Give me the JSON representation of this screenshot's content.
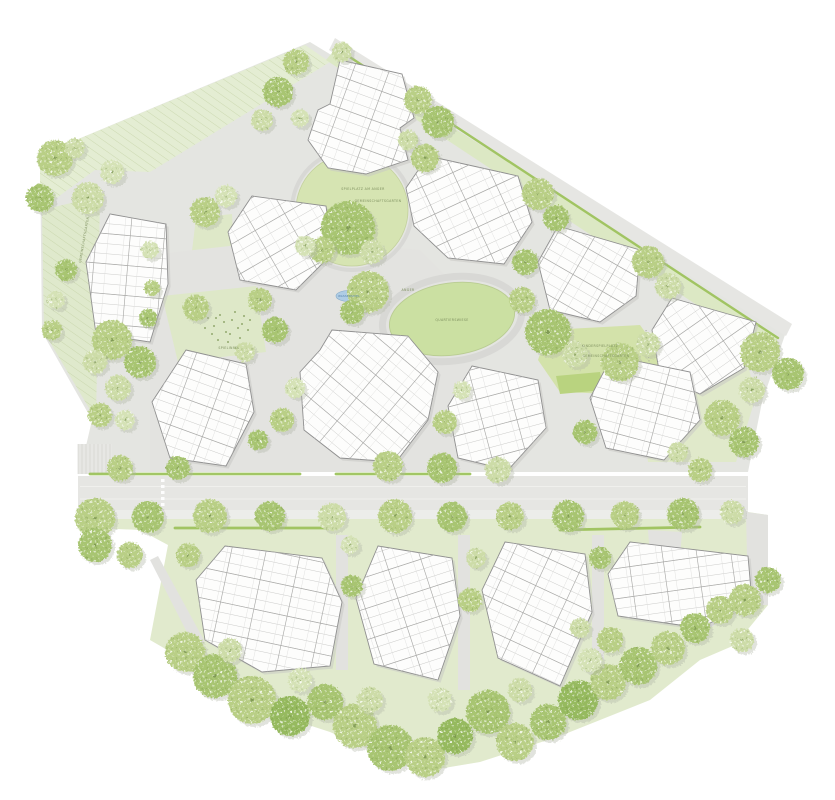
{
  "canvas": {
    "width": 835,
    "height": 800,
    "background": "#ffffff"
  },
  "palette": {
    "north_base": "#e4e5e1",
    "south_base": "#e1eacd",
    "nw_slope": "#e4edd3",
    "west_strip": "#dfe9cc",
    "ne_band_green": "#dce8c4",
    "east_patch": "#e0e9ca",
    "plaza": "#e3e3e0",
    "garden": "#dee8c8",
    "bright_patch": "#b9d37f",
    "road": "#e6e6e3",
    "sidewalk": "#ecedea",
    "path": "#e2e2df",
    "hedge": "#9ec35d",
    "oval_fill": "#cbe0a2",
    "oval_stroke": "#b9cc92",
    "ring": "#d8d8d5",
    "circle_lawn": "#d6e4b2",
    "building_fill": "#fdfdfc",
    "building_stroke": "#8f8f8f",
    "building_shadow": "#c8c8c5",
    "grid_line": "#c9c9c7",
    "grid_line2": "#dddddc",
    "grid_accent": "#a9a9a7",
    "tree_shadow": "#b0b5a6",
    "water_fill": "#aecce4",
    "water_stroke": "#85aac9",
    "label_color": "#7d8f5e",
    "dot_color": "#7d9553",
    "parking_line": "#c9c9c6",
    "lane_line": "#f3f3f0"
  },
  "site": {
    "north_base": "310,42 786,332 762,402 748,472 80,472 92,420 42,332 40,155",
    "south_base": "80,500 748,500 748,512 768,515 768,605 735,645 700,660 650,700 560,736 480,762 420,772 330,732 250,706 195,666 150,640 168,545 140,530 95,528 80,512",
    "lawns": [
      {
        "name": "nw-slope-meadow",
        "points": "40,155 305,45 330,62 150,172 95,170 40,210",
        "fill": "nw_slope",
        "hatch": true
      },
      {
        "name": "west-meadow-strip",
        "points": "42,210 100,196 96,420 44,332",
        "fill": "west_strip",
        "hatch": true
      },
      {
        "name": "ne-edge-green-band",
        "points": "336,48 778,338 768,352 326,60",
        "fill": "ne_band_green",
        "hatch": false
      },
      {
        "name": "east-garden-wedge",
        "points": "640,388 744,350 756,396 736,462 648,462",
        "fill": "east_patch",
        "hatch": false
      },
      {
        "name": "garden-between-west-clusters",
        "points": "196,218 232,214 236,298 186,300",
        "fill": "garden",
        "hatch": false
      }
    ],
    "plaza": "150,255 300,238 420,250 470,300 470,472 150,472",
    "garden_playground": "162,296 256,286 266,352 178,362",
    "bright_patch": "556,376 600,372 604,390 560,394",
    "playground_green": "548,330 640,325 665,360 640,395 560,392 538,360",
    "roads": {
      "ne_band": "335,38 792,324 786,336 329,50",
      "main": "78,476 748,476 748,510 78,510",
      "sidewalk": "78,510 748,510 748,519 78,519",
      "east_path": "746,512 768,515 768,605 748,605"
    },
    "south_paths": [
      "336,535 348,535 348,670 336,670",
      "458,535 470,535 470,690 458,690",
      "592,535 604,535 604,660 592,660",
      "150,560 158,556 205,642 195,648",
      "700,622 744,598 748,606 706,630",
      "648,530 682,532 680,558 650,556"
    ],
    "hedges": [
      [
        336,
        48,
        778,
        338
      ],
      [
        90,
        474,
        300,
        474
      ],
      [
        336,
        474,
        470,
        474
      ],
      [
        175,
        528,
        330,
        528
      ],
      [
        560,
        530,
        700,
        527
      ]
    ],
    "lane_lines": [
      [
        80,
        486.5,
        746,
        486.5
      ],
      [
        80,
        499,
        746,
        499
      ]
    ],
    "crosswalk": {
      "x": 161,
      "y0": 479,
      "count": 5,
      "step": 6
    },
    "parking": {
      "x": 78,
      "y": 444,
      "w": 34,
      "h": 30,
      "spacing": 4
    },
    "dashed_path": [
      646,
      330,
      652,
      392
    ],
    "oval": {
      "cx": 452,
      "cy": 319,
      "rx": 63,
      "ry": 36,
      "ring_rx": 70,
      "ring_ry": 42,
      "rotate": -8
    },
    "circle_lawn": {
      "cx": 352,
      "cy": 210,
      "r": 56
    },
    "water": {
      "cx": 349,
      "cy": 296,
      "rx": 13,
      "ry": 5.5
    },
    "playground_dots": [
      [
        208,
        318
      ],
      [
        214,
        326
      ],
      [
        220,
        315
      ],
      [
        226,
        332
      ],
      [
        232,
        320
      ],
      [
        238,
        328
      ],
      [
        244,
        316
      ],
      [
        218,
        340
      ],
      [
        228,
        342
      ],
      [
        240,
        338
      ],
      [
        248,
        330
      ],
      [
        212,
        334
      ],
      [
        250,
        320
      ],
      [
        205,
        328
      ],
      [
        235,
        312
      ],
      [
        246,
        344
      ],
      [
        224,
        322
      ],
      [
        242,
        324
      ],
      [
        230,
        334
      ],
      [
        216,
        318
      ]
    ]
  },
  "buildings": [
    {
      "name": "cluster-north-top",
      "points": "340,60 402,74 414,118 400,128 408,160 366,174 328,168 308,140 318,110 330,104",
      "angle": 20
    },
    {
      "name": "cluster-north-upper-right",
      "points": "428,156 518,176 532,222 504,264 448,258 414,226 406,188",
      "angle": -25
    },
    {
      "name": "cluster-north-right",
      "points": "558,226 640,250 636,296 600,322 550,310 538,262",
      "angle": 30
    },
    {
      "name": "cluster-east-corner",
      "points": "672,298 756,322 744,368 700,394 660,376 652,330",
      "angle": -35
    },
    {
      "name": "cluster-east-mid",
      "points": "612,356 690,372 700,420 664,460 606,448 590,398",
      "angle": 15
    },
    {
      "name": "cluster-center",
      "points": "332,330 408,336 438,372 428,420 396,462 340,458 304,430 300,372 320,350",
      "angle": 40
    },
    {
      "name": "cluster-center-right",
      "points": "472,366 538,380 546,428 508,470 458,458 448,406",
      "angle": -15
    },
    {
      "name": "cluster-west-mid",
      "points": "186,350 246,364 254,412 226,466 170,458 152,402",
      "angle": 20
    },
    {
      "name": "cluster-northwest-inner",
      "points": "252,196 326,206 332,254 296,290 240,280 228,232",
      "angle": -30
    },
    {
      "name": "cluster-far-west",
      "points": "110,214 166,224 168,284 150,342 96,334 86,262",
      "angle": 5
    },
    {
      "name": "cluster-south-1",
      "points": "225,546 322,558 342,602 330,666 262,672 205,640 196,580",
      "angle": 12
    },
    {
      "name": "cluster-south-2",
      "points": "378,546 452,558 460,616 438,680 374,664 356,598",
      "angle": -18
    },
    {
      "name": "cluster-south-3",
      "points": "505,542 585,554 592,612 560,686 498,658 482,590",
      "angle": 25
    },
    {
      "name": "cluster-south-4",
      "points": "630,542 748,556 752,602 700,628 618,616 608,574",
      "angle": -8
    }
  ],
  "trees": {
    "tones": [
      "#cddca8",
      "#b9cf86",
      "#a8c572",
      "#d5e2b6",
      "#96ba5e"
    ],
    "items": [
      [
        55,
        158,
        18,
        1
      ],
      [
        40,
        198,
        14,
        2
      ],
      [
        88,
        198,
        16,
        0
      ],
      [
        112,
        172,
        12,
        3
      ],
      [
        75,
        148,
        10,
        0
      ],
      [
        205,
        212,
        15,
        1
      ],
      [
        226,
        196,
        11,
        3
      ],
      [
        66,
        270,
        11,
        2
      ],
      [
        56,
        300,
        9,
        3
      ],
      [
        52,
        330,
        10,
        1
      ],
      [
        150,
        250,
        9,
        3
      ],
      [
        152,
        288,
        8,
        1
      ],
      [
        148,
        318,
        9,
        2
      ],
      [
        112,
        340,
        20,
        1
      ],
      [
        140,
        362,
        16,
        2
      ],
      [
        118,
        388,
        13,
        0
      ],
      [
        100,
        415,
        12,
        1
      ],
      [
        125,
        420,
        10,
        3
      ],
      [
        95,
        362,
        12,
        0
      ],
      [
        296,
        62,
        13,
        1
      ],
      [
        278,
        92,
        15,
        2
      ],
      [
        262,
        120,
        11,
        0
      ],
      [
        300,
        118,
        9,
        3
      ],
      [
        342,
        52,
        10,
        0
      ],
      [
        418,
        100,
        14,
        1
      ],
      [
        438,
        122,
        16,
        2
      ],
      [
        408,
        140,
        10,
        0
      ],
      [
        538,
        194,
        16,
        1
      ],
      [
        556,
        218,
        13,
        2
      ],
      [
        648,
        262,
        16,
        1
      ],
      [
        668,
        286,
        13,
        0
      ],
      [
        760,
        352,
        20,
        1
      ],
      [
        788,
        374,
        16,
        2
      ],
      [
        752,
        390,
        13,
        0
      ],
      [
        722,
        418,
        18,
        1
      ],
      [
        744,
        442,
        15,
        2
      ],
      [
        348,
        228,
        27,
        2
      ],
      [
        322,
        250,
        13,
        1
      ],
      [
        372,
        252,
        12,
        0
      ],
      [
        305,
        246,
        10,
        3
      ],
      [
        260,
        300,
        12,
        1
      ],
      [
        275,
        330,
        13,
        2
      ],
      [
        245,
        352,
        10,
        0
      ],
      [
        196,
        308,
        13,
        1
      ],
      [
        368,
        292,
        21,
        1
      ],
      [
        352,
        312,
        12,
        2
      ],
      [
        425,
        158,
        14,
        1
      ],
      [
        525,
        262,
        13,
        2
      ],
      [
        522,
        300,
        13,
        1
      ],
      [
        548,
        332,
        23,
        2
      ],
      [
        575,
        354,
        13,
        0
      ],
      [
        620,
        362,
        19,
        1
      ],
      [
        648,
        344,
        12,
        0
      ],
      [
        445,
        422,
        12,
        1
      ],
      [
        462,
        390,
        9,
        3
      ],
      [
        585,
        432,
        12,
        2
      ],
      [
        700,
        470,
        12,
        1
      ],
      [
        678,
        452,
        10,
        0
      ],
      [
        295,
        388,
        10,
        3
      ],
      [
        282,
        420,
        12,
        1
      ],
      [
        258,
        440,
        10,
        2
      ],
      [
        120,
        468,
        13,
        1
      ],
      [
        178,
        468,
        12,
        2
      ],
      [
        388,
        466,
        15,
        1
      ],
      [
        442,
        468,
        15,
        2
      ],
      [
        498,
        470,
        13,
        0
      ],
      [
        95,
        518,
        20,
        1
      ],
      [
        148,
        517,
        16,
        2
      ],
      [
        210,
        516,
        17,
        1
      ],
      [
        270,
        516,
        15,
        2
      ],
      [
        332,
        517,
        14,
        0
      ],
      [
        395,
        516,
        17,
        1
      ],
      [
        452,
        517,
        15,
        2
      ],
      [
        510,
        516,
        14,
        1
      ],
      [
        568,
        516,
        16,
        2
      ],
      [
        625,
        515,
        14,
        1
      ],
      [
        683,
        514,
        16,
        2
      ],
      [
        732,
        512,
        12,
        0
      ],
      [
        188,
        555,
        12,
        1
      ],
      [
        352,
        586,
        11,
        2
      ],
      [
        470,
        600,
        12,
        1
      ],
      [
        476,
        558,
        10,
        0
      ],
      [
        600,
        558,
        11,
        2
      ],
      [
        350,
        545,
        9,
        3
      ],
      [
        610,
        640,
        13,
        1
      ],
      [
        580,
        628,
        10,
        0
      ],
      [
        185,
        652,
        20,
        1
      ],
      [
        215,
        676,
        22,
        2
      ],
      [
        252,
        700,
        24,
        1
      ],
      [
        290,
        716,
        20,
        4
      ],
      [
        325,
        702,
        18,
        2
      ],
      [
        355,
        726,
        22,
        1
      ],
      [
        390,
        748,
        23,
        2
      ],
      [
        425,
        757,
        20,
        1
      ],
      [
        455,
        736,
        18,
        4
      ],
      [
        488,
        712,
        22,
        2
      ],
      [
        515,
        742,
        19,
        1
      ],
      [
        548,
        722,
        18,
        2
      ],
      [
        578,
        700,
        20,
        4
      ],
      [
        608,
        682,
        18,
        1
      ],
      [
        638,
        666,
        19,
        2
      ],
      [
        668,
        648,
        17,
        1
      ],
      [
        695,
        628,
        15,
        2
      ],
      [
        720,
        610,
        14,
        1
      ],
      [
        230,
        650,
        12,
        0
      ],
      [
        300,
        680,
        12,
        3
      ],
      [
        370,
        700,
        13,
        0
      ],
      [
        440,
        700,
        12,
        3
      ],
      [
        520,
        690,
        12,
        0
      ],
      [
        590,
        660,
        12,
        3
      ],
      [
        745,
        600,
        16,
        1
      ],
      [
        768,
        580,
        13,
        2
      ],
      [
        742,
        640,
        12,
        0
      ],
      [
        95,
        545,
        17,
        2
      ],
      [
        130,
        555,
        13,
        1
      ]
    ]
  },
  "labels": [
    {
      "text": "SPIELPLATZ AM ANGER",
      "x": 363,
      "y": 190,
      "rotate": 0
    },
    {
      "text": "GEMEINSCHAFTSGARTEN",
      "x": 378,
      "y": 202,
      "rotate": 0
    },
    {
      "text": "QUARTIERSWIESE",
      "x": 452,
      "y": 321,
      "rotate": 0
    },
    {
      "text": "WASSERSPIEL",
      "x": 349,
      "y": 297,
      "rotate": 0,
      "color": "#4d7ba6",
      "size": 2.6
    },
    {
      "text": "KINDERSPIELPLATZ",
      "x": 600,
      "y": 347,
      "rotate": 0
    },
    {
      "text": "GEMEINSCHAFTSGARTEN",
      "x": 606,
      "y": 357,
      "rotate": 0
    },
    {
      "text": "GEMEINSCHAFTSGARTEN",
      "x": 85,
      "y": 240,
      "rotate": -80
    },
    {
      "text": "ANGER",
      "x": 408,
      "y": 291,
      "rotate": 0
    },
    {
      "text": "SPIELINSEL",
      "x": 229,
      "y": 349,
      "rotate": 0
    }
  ]
}
